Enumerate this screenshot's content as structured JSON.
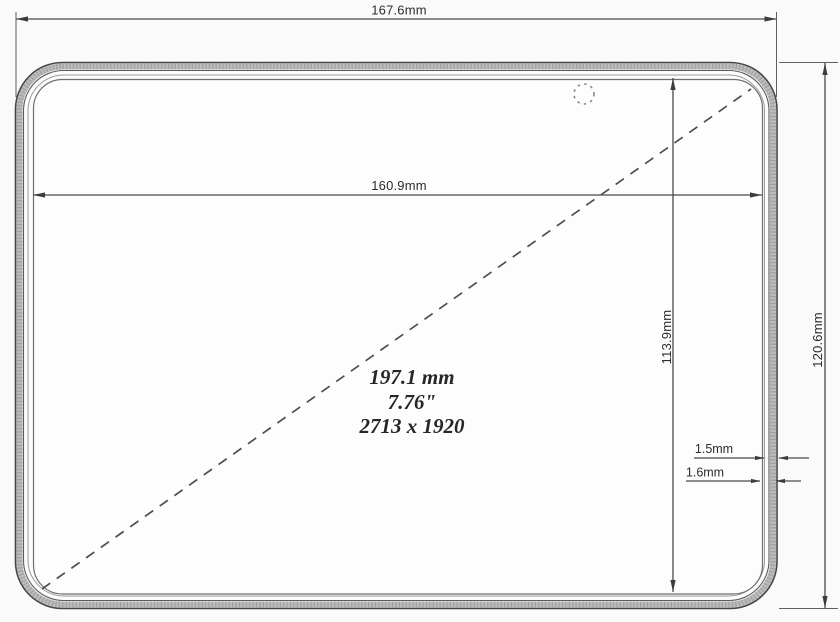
{
  "drawing": {
    "labels": {
      "outer_width": "167.6mm",
      "screen_width": "160.9mm",
      "screen_height": "113.9mm",
      "outer_height": "120.6mm",
      "bezel_side": "1.5mm",
      "bezel_edge": "1.6mm"
    },
    "diagonal": {
      "mm": "197.1 mm",
      "inches": "7.76\"",
      "resolution": "2713 x 1920"
    }
  },
  "colors": {
    "background": "#fafafa",
    "outline": "#454545",
    "bezel_band": "#bcbcbc",
    "dimension_line": "#4a4a4a",
    "text": "#2c2c2c"
  }
}
